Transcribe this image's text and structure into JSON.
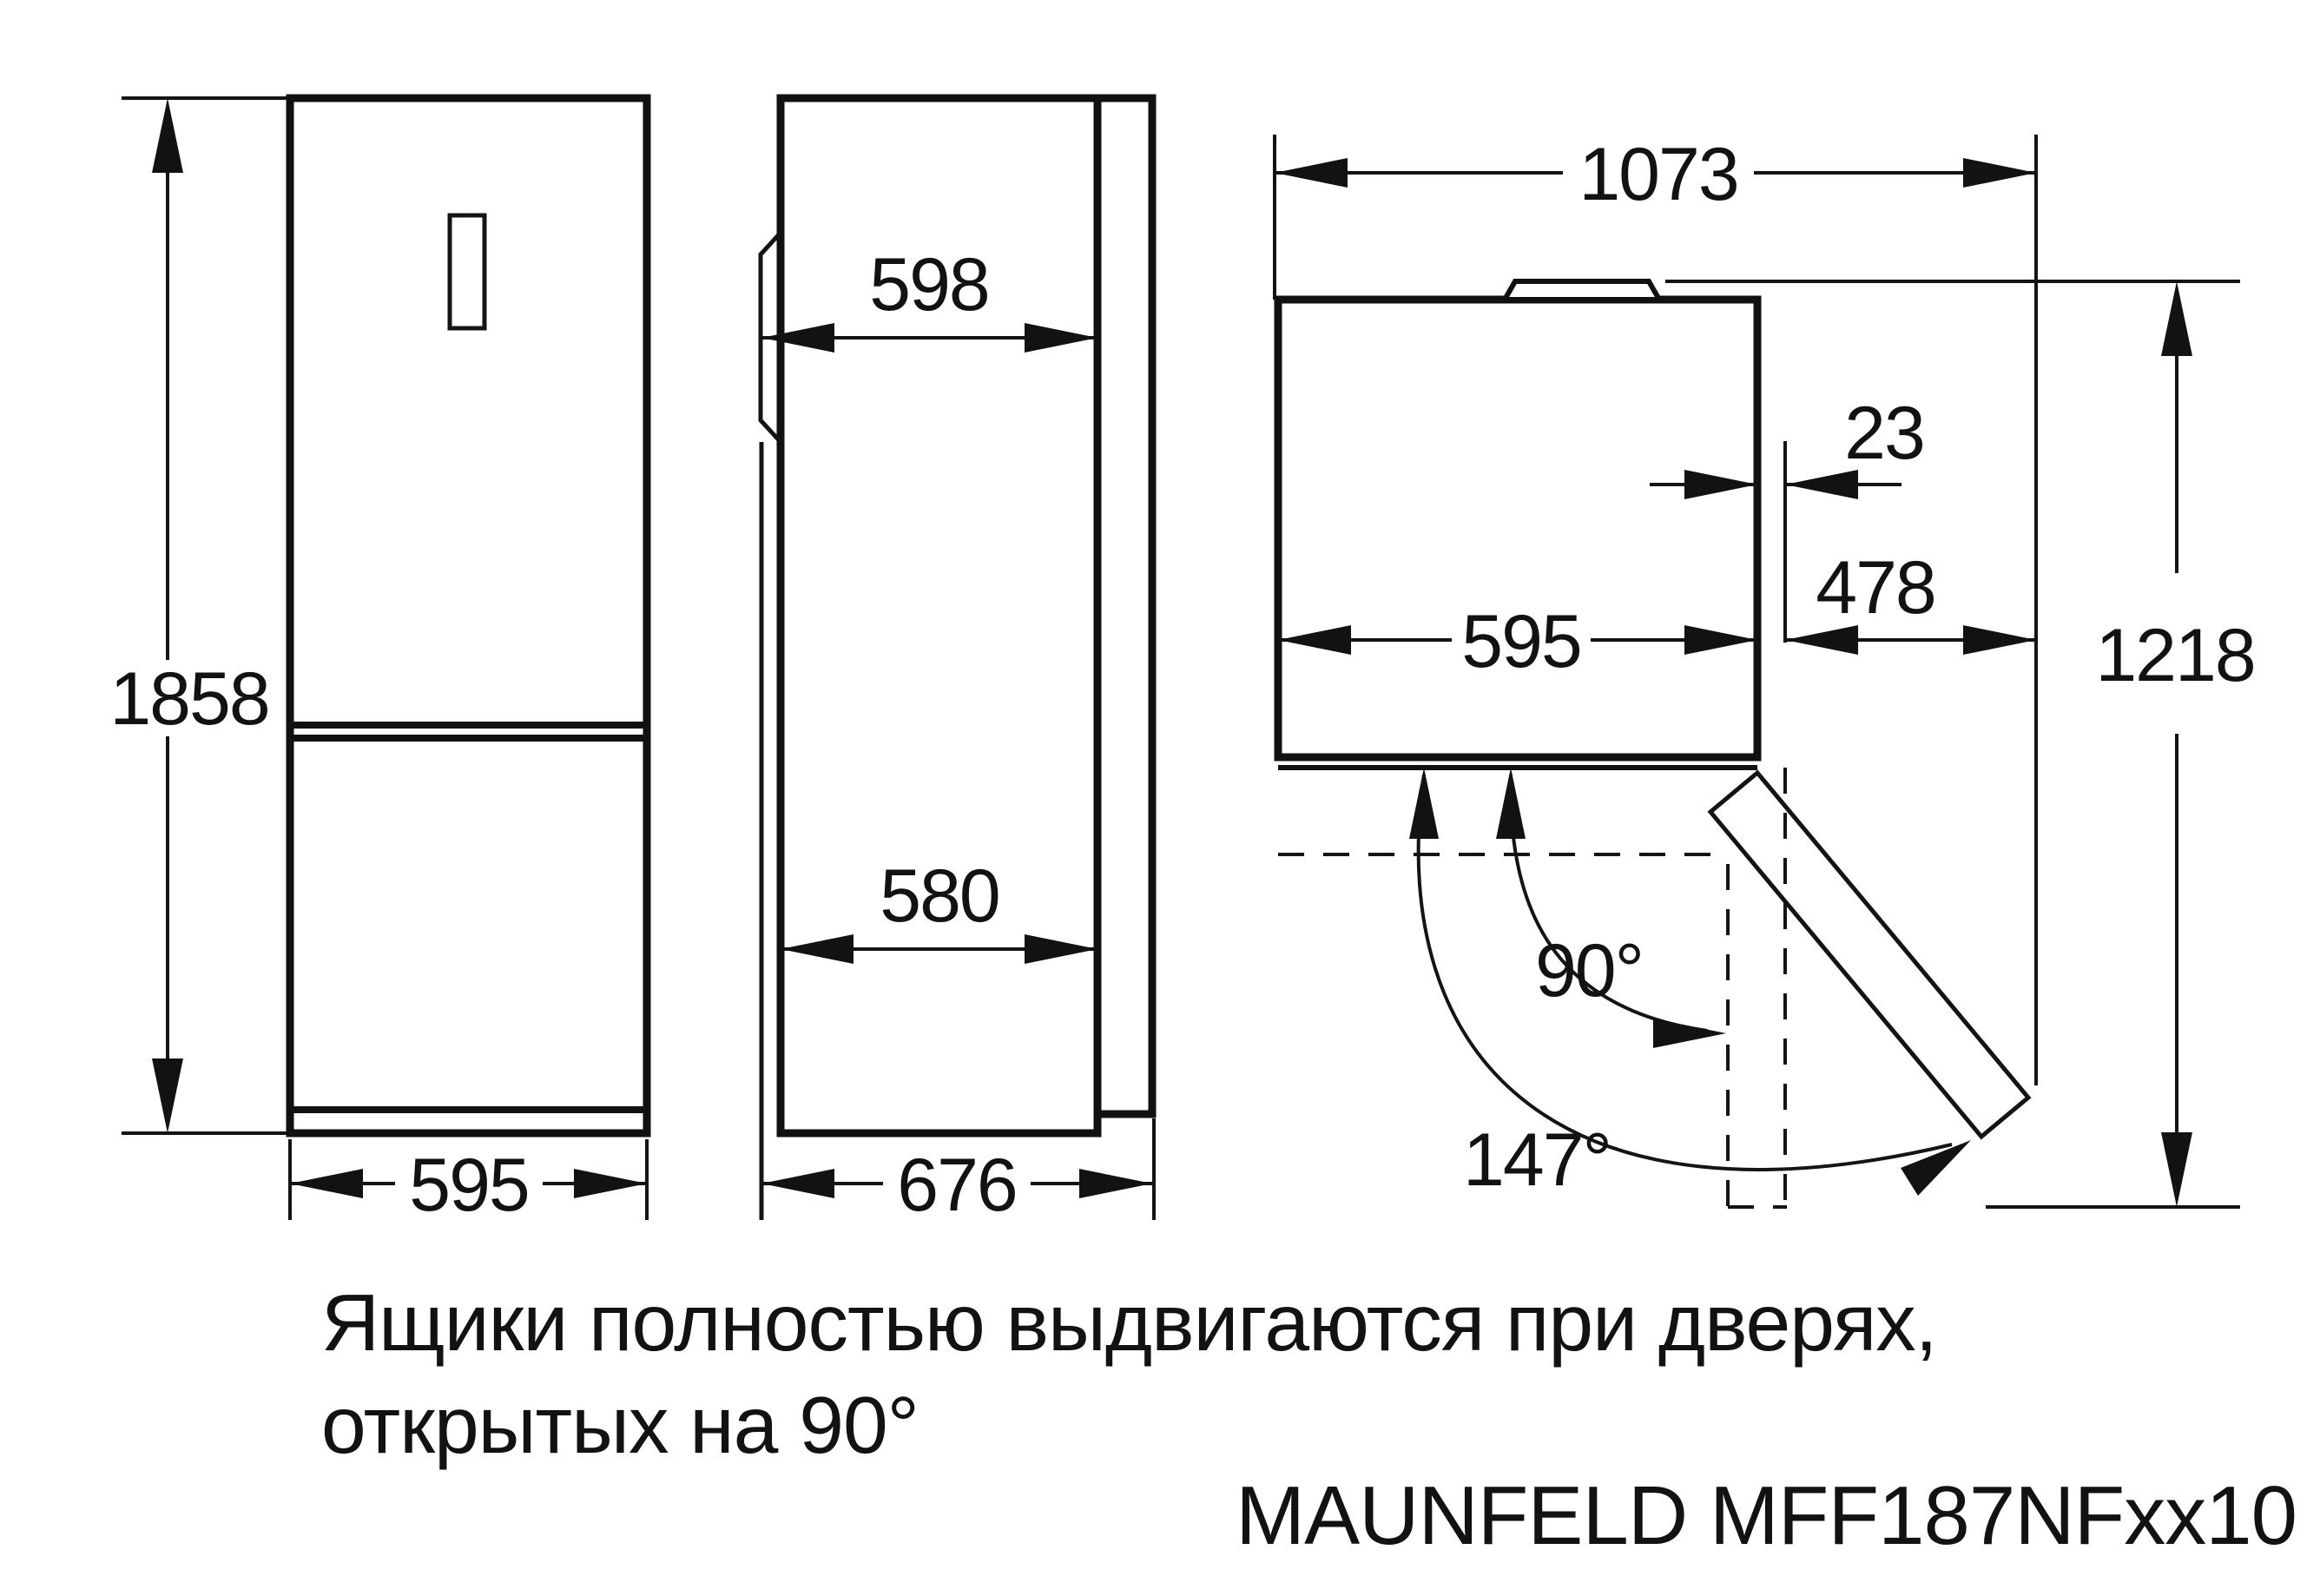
{
  "title": "Refrigerator dimension drawing",
  "model_label": "MAUNFELD MFF187NFxx10",
  "caption": {
    "line1": "Ящики полностью выдвигаются при дверях,",
    "line2": "открытых на 90°"
  },
  "dimensions": {
    "front": {
      "height": "1858",
      "width": "595"
    },
    "side": {
      "door_depth": "598",
      "body_depth": "580",
      "total_depth": "676"
    },
    "top": {
      "open_width": "1073",
      "side_clearance": "23",
      "door_width": "478",
      "width": "595",
      "open_depth": "1218",
      "angle_90": "90°",
      "angle_max": "147°"
    }
  },
  "colors": {
    "line": "#141414",
    "background": "#ffffff"
  }
}
